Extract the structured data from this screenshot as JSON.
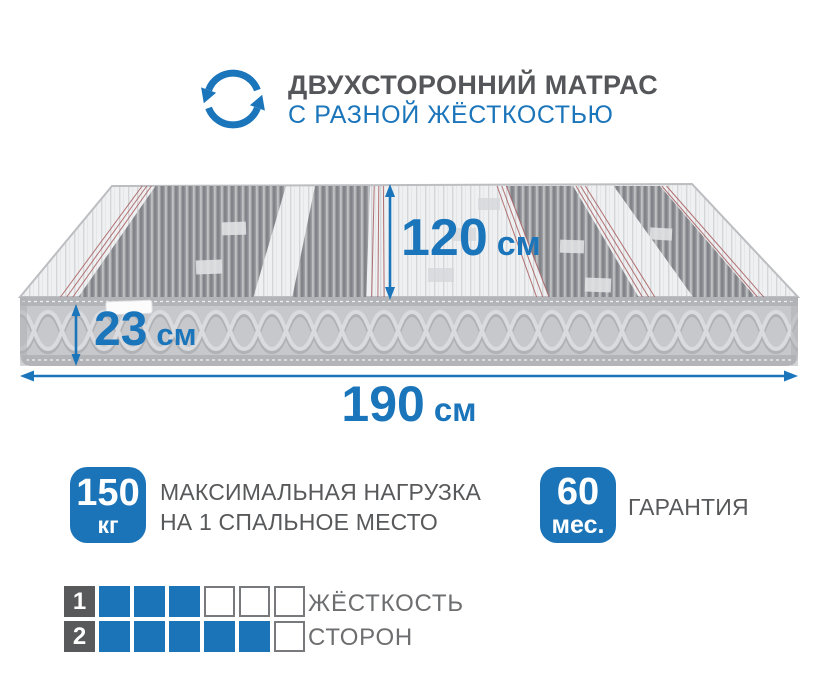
{
  "header": {
    "title": "ДВУХСТОРОННИЙ МАТРАС",
    "subtitle": "С РАЗНОЙ ЖЁСТКОСТЬЮ",
    "icon": "rotate-arrows-icon"
  },
  "dimensions": {
    "width": {
      "value": "120",
      "unit": "см"
    },
    "height": {
      "value": "23",
      "unit": "см"
    },
    "length": {
      "value": "190",
      "unit": "см"
    }
  },
  "max_load": {
    "value": "150",
    "unit": "кг",
    "line1": "МАКСИМАЛЬНАЯ НАГРУЗКА",
    "line2": "НА 1 СПАЛЬНОЕ МЕСТО"
  },
  "warranty": {
    "value": "60",
    "unit": "мес.",
    "label": "ГАРАНТИЯ"
  },
  "firmness": {
    "label_line1": "ЖЁСТКОСТЬ",
    "label_line2": "СТОРОН",
    "rows": [
      {
        "side": "1",
        "filled": 3,
        "total": 6
      },
      {
        "side": "2",
        "filled": 5,
        "total": 6
      }
    ]
  },
  "colors": {
    "accent_blue": "#1b75bb",
    "badge_blue": "#1b74b7",
    "title_gray": "#55565a",
    "text_gray": "#6d6e70",
    "number_square_gray": "#58595b"
  }
}
